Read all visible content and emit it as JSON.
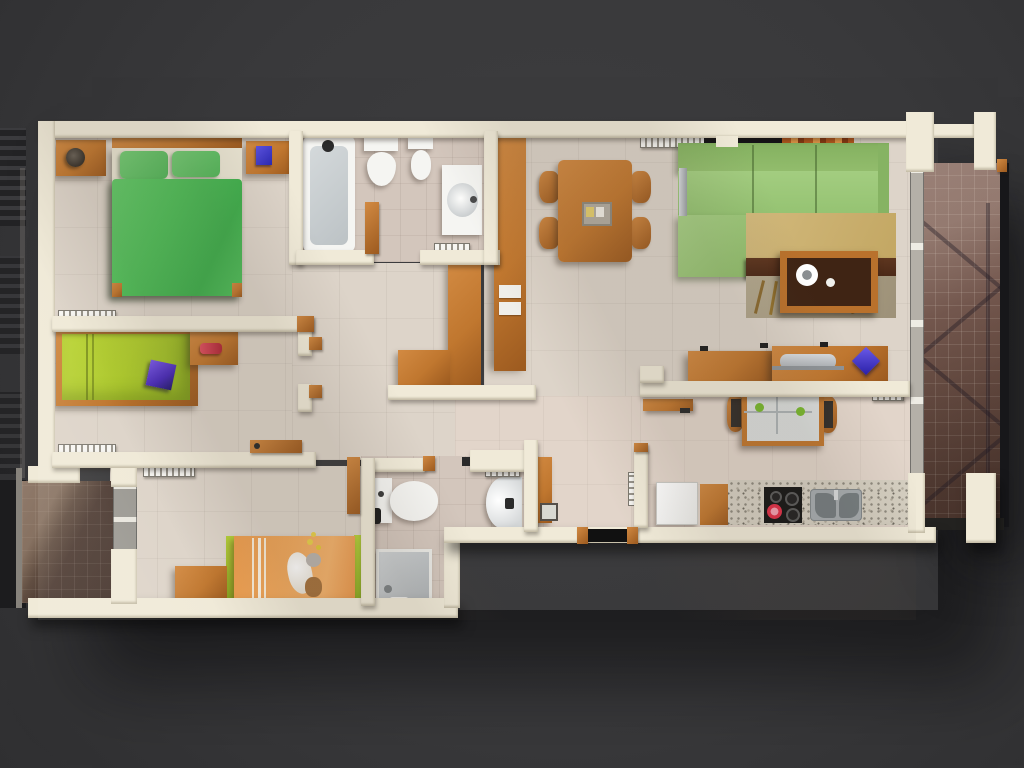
{
  "meta": {
    "description": "3D top-down architectural render of a three-bedroom apartment floor plan on a dark gray backdrop",
    "visible_text": "none"
  },
  "colors": {
    "bg": "#3a3a3c",
    "wall": "#f0ead8",
    "floor": "#ddd4c9",
    "floor_bath": "#d3c6bc",
    "floor_kitchen": "#e2d5ca",
    "wood": "#c0772f",
    "wood_light": "#d28a42",
    "wood_dark": "#9c5a1f",
    "green_duvet": "#4fbe58",
    "sofa_green": "#9cc878",
    "lime_mattress": "#aeca2e",
    "kid_bed_orange": "#efa55b",
    "rug_tan": "#c9ad6d",
    "rug_dark_band": "#55301d",
    "balcony_left_tile": "#4c3a32",
    "balcony_right_tile": "#6d5147",
    "glass_gray": "#b4b0a8",
    "granite": "#d6d0c2",
    "steel": "#a7adb0",
    "cooktop_black": "#161616",
    "pot_red": "#e03048",
    "book_blue": "#3230c4",
    "laptop_purple": "#5b3ad0",
    "toy_red": "#cf4050",
    "window_warm": "#e89b4a"
  },
  "rooms": [
    {
      "name": "master-bedroom",
      "items": [
        "double-bed-green",
        "nightstand-left",
        "table-lamp",
        "nightstand-right",
        "blue-book",
        "radiator"
      ]
    },
    {
      "name": "bathroom-main",
      "items": [
        "bathtub",
        "toilet",
        "bidet",
        "sink-cabinet",
        "radiator",
        "door-open"
      ]
    },
    {
      "name": "bedroom-2",
      "items": [
        "single-bed-lime",
        "purple-laptop",
        "desk",
        "red-toy",
        "radiator"
      ]
    },
    {
      "name": "bedroom-3-kids",
      "items": [
        "kids-bed-orange-sheep",
        "teddy-bear",
        "side-table",
        "radiator",
        "balcony-glass-door"
      ]
    },
    {
      "name": "bathroom-2",
      "items": [
        "toilet",
        "round-wall-sink",
        "shower-tray",
        "towel-rail",
        "radiator",
        "door-open"
      ]
    },
    {
      "name": "hallway",
      "items": [
        "tall-wardrobe",
        "l-shaped-sideboard",
        "shoe-cabinet",
        "entry-door",
        "doormat",
        "radiator"
      ]
    },
    {
      "name": "living-dining",
      "items": [
        "corner-sofa-green",
        "rug",
        "tv-bench",
        "coffee-table",
        "dining-table",
        "dining-chairs-x4",
        "office-desk",
        "laptop",
        "window-band",
        "radiator"
      ]
    },
    {
      "name": "kitchen",
      "items": [
        "fridge",
        "cabinet",
        "granite-counter",
        "cooktop",
        "red-pot",
        "double-sink",
        "breakfast-table",
        "chairs-x2",
        "wall-shelf",
        "radiator"
      ]
    },
    {
      "name": "balcony-left",
      "items": [
        "tiled-floor",
        "glass-railing"
      ]
    },
    {
      "name": "balcony-right",
      "items": [
        "tiled-floor",
        "railing-shadow-truss",
        "glass-sliding-wall"
      ]
    }
  ]
}
